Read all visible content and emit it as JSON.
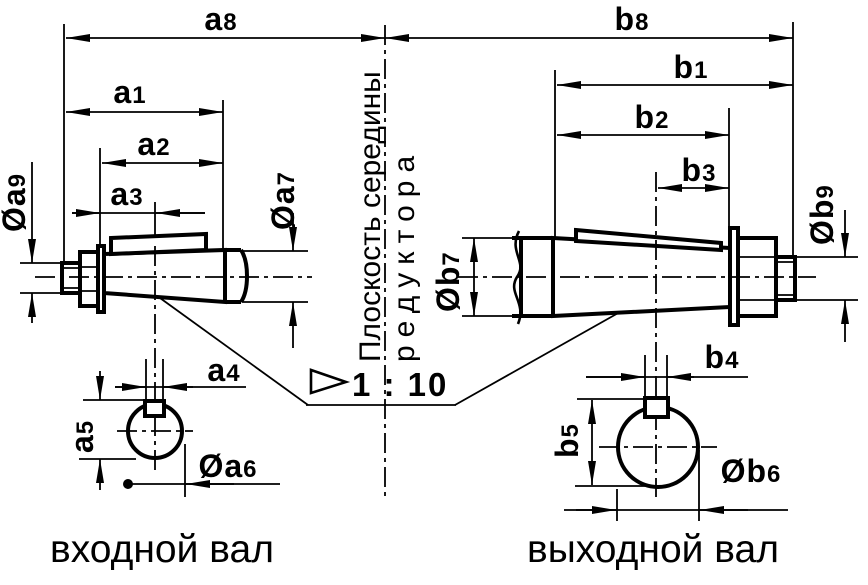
{
  "captions": {
    "input_shaft": "входной вал",
    "output_shaft": "выходной вал"
  },
  "center_plane": {
    "line1": "Плоскость середины",
    "line2": "редуктора"
  },
  "taper": {
    "label": "1 : 10"
  },
  "dims": {
    "a1": {
      "prefix": "",
      "base": "a",
      "sub": "1"
    },
    "a2": {
      "prefix": "",
      "base": "a",
      "sub": "2"
    },
    "a3": {
      "prefix": "",
      "base": "a",
      "sub": "3"
    },
    "a4": {
      "prefix": "",
      "base": "a",
      "sub": "4"
    },
    "a5": {
      "prefix": "",
      "base": "a",
      "sub": "5"
    },
    "a6": {
      "prefix": "Ø",
      "base": "a",
      "sub": "6"
    },
    "a7": {
      "prefix": "Ø",
      "base": "a",
      "sub": "7"
    },
    "a8": {
      "prefix": "",
      "base": "a",
      "sub": "8"
    },
    "a9": {
      "prefix": "Ø",
      "base": "a",
      "sub": "9"
    },
    "b1": {
      "prefix": "",
      "base": "b",
      "sub": "1"
    },
    "b2": {
      "prefix": "",
      "base": "b",
      "sub": "2"
    },
    "b3": {
      "prefix": "",
      "base": "b",
      "sub": "3"
    },
    "b4": {
      "prefix": "",
      "base": "b",
      "sub": "4"
    },
    "b5": {
      "prefix": "",
      "base": "b",
      "sub": "5"
    },
    "b6": {
      "prefix": "Ø",
      "base": "b",
      "sub": "6"
    },
    "b7": {
      "prefix": "Ø",
      "base": "b",
      "sub": "7"
    },
    "b8": {
      "prefix": "",
      "base": "b",
      "sub": "8"
    },
    "b9": {
      "prefix": "Ø",
      "base": "b",
      "sub": "9"
    }
  }
}
